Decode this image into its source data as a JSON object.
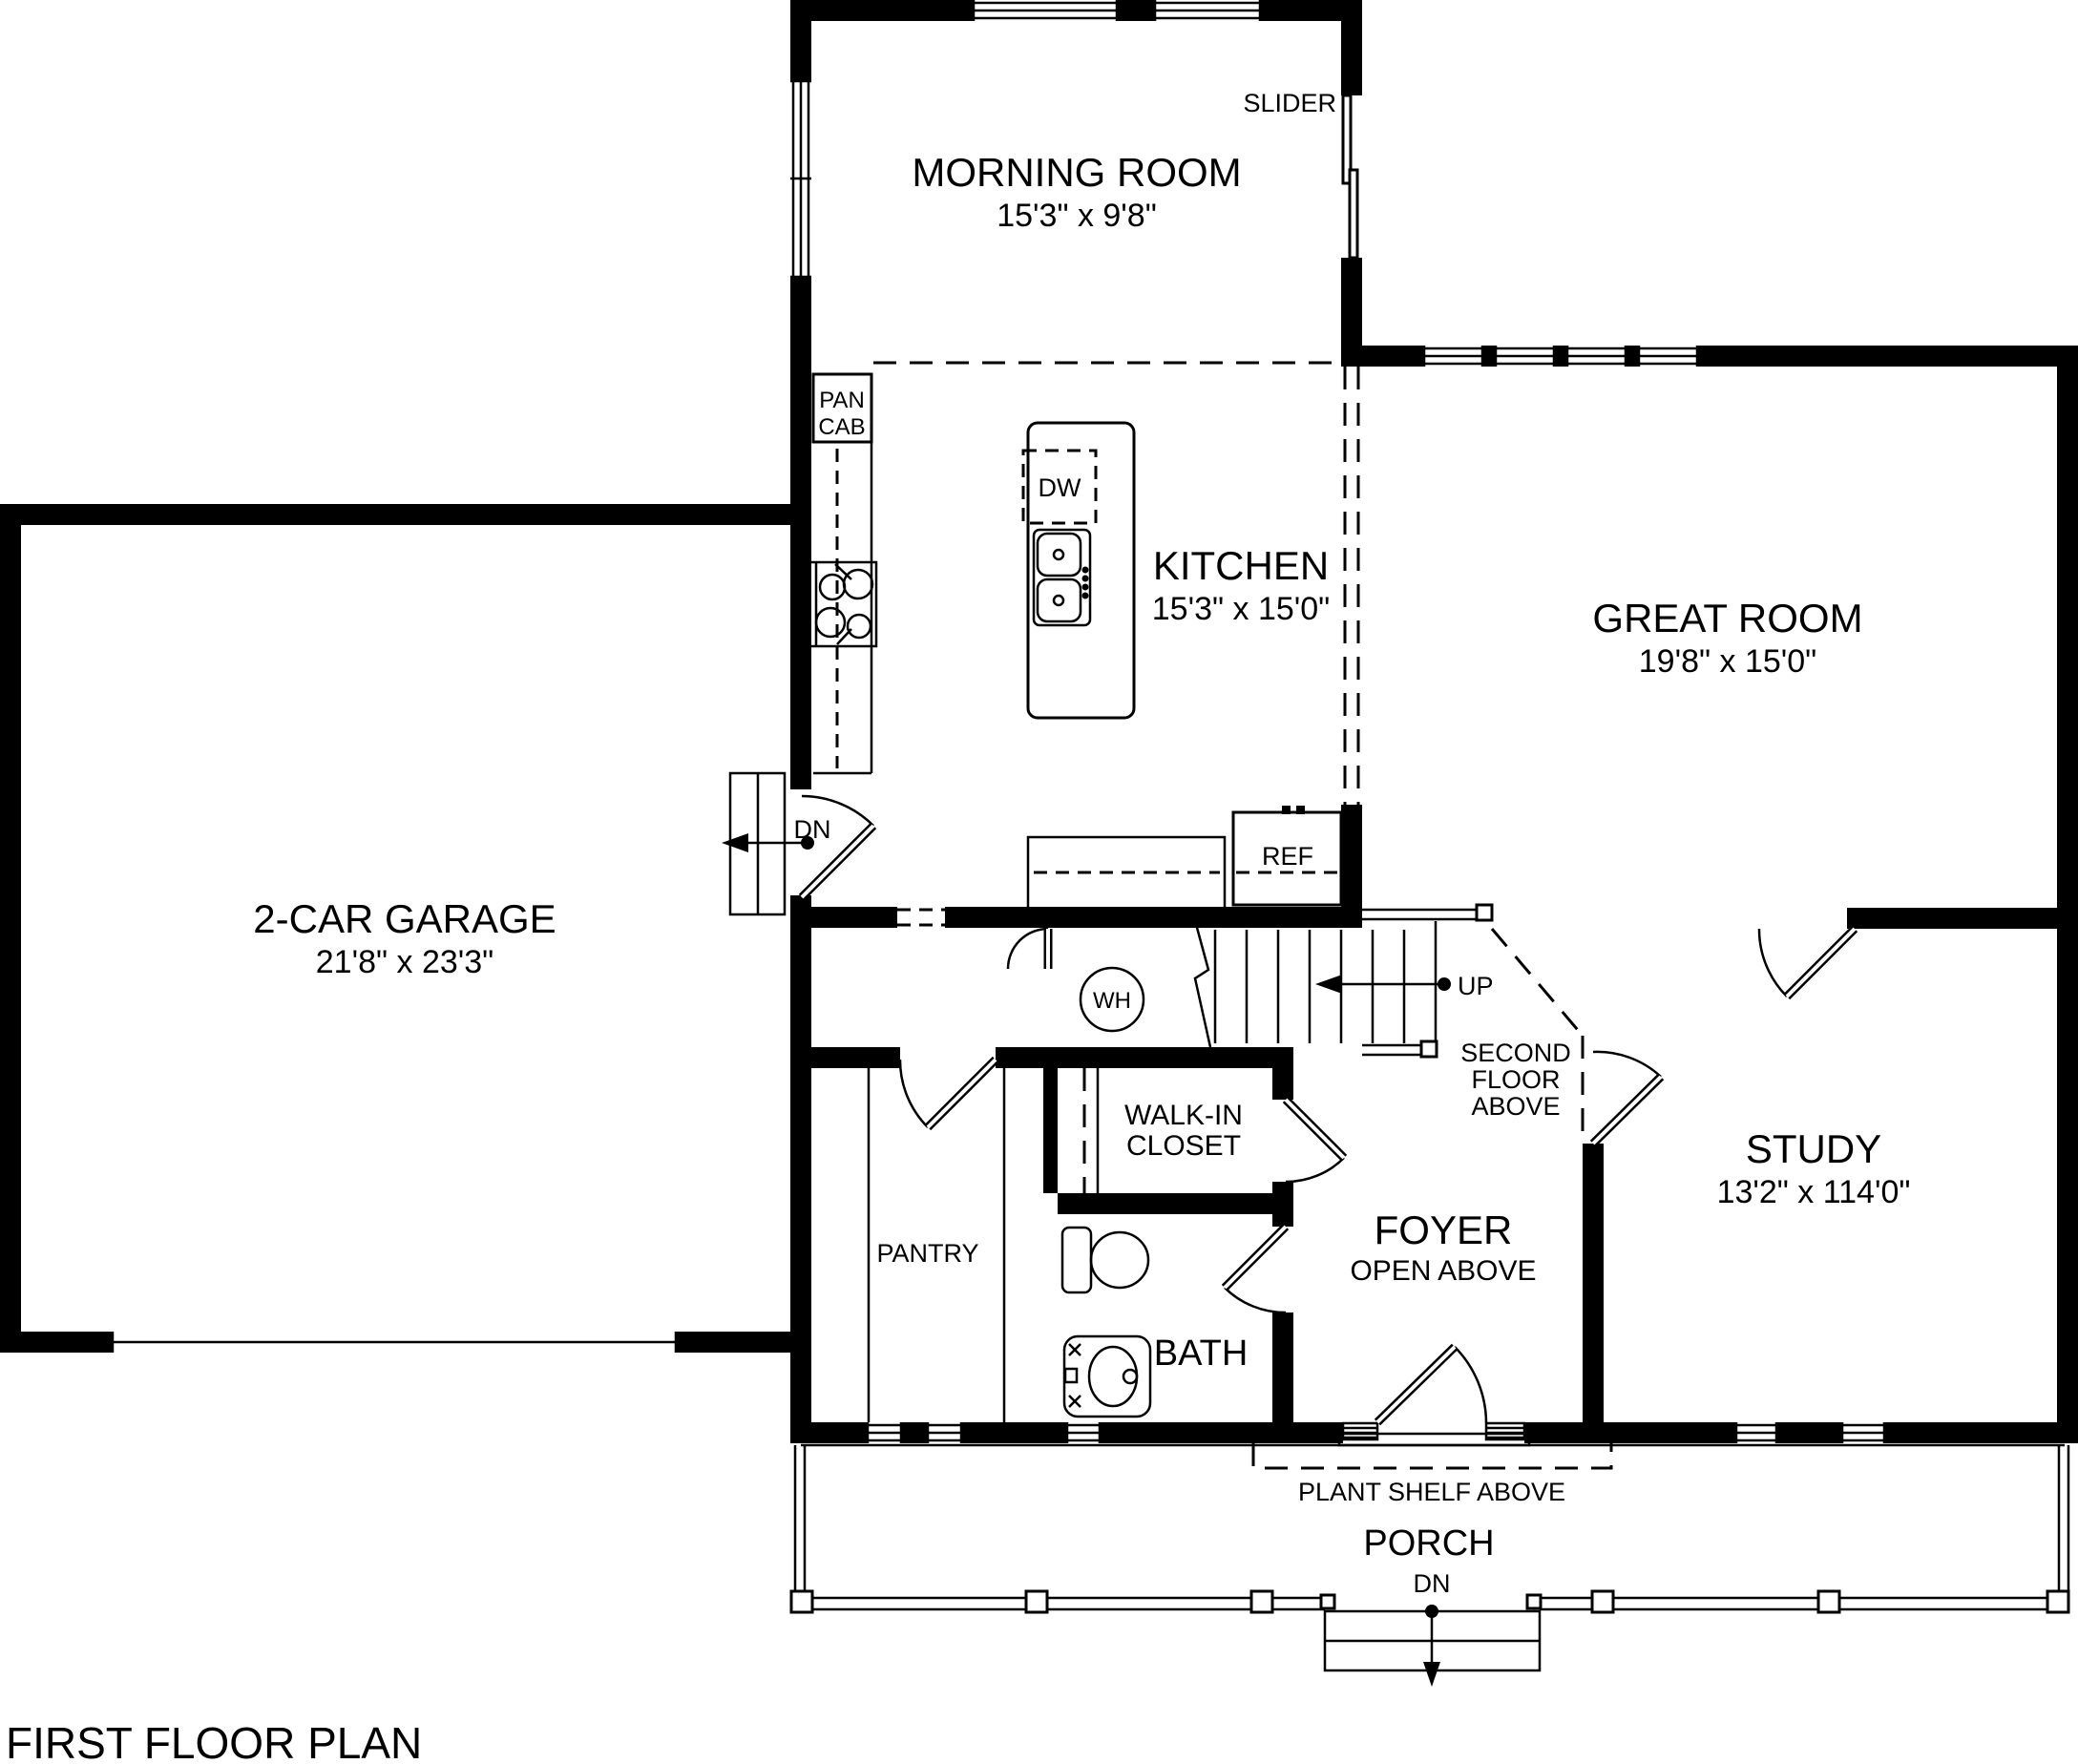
{
  "page": {
    "title": "FIRST FLOOR PLAN",
    "colors": {
      "ink": "#000000",
      "paper": "#ffffff"
    }
  },
  "rooms": {
    "morning_room": {
      "name": "MORNING ROOM",
      "dims": "15'3\" x 9'8\""
    },
    "kitchen": {
      "name": "KITCHEN",
      "dims": "15'3\" x 15'0\""
    },
    "great_room": {
      "name": "GREAT ROOM",
      "dims": "19'8\" x 15'0\""
    },
    "garage": {
      "name": "2-CAR GARAGE",
      "dims": "21'8\" x 23'3\""
    },
    "study": {
      "name": "STUDY",
      "dims": "13'2\" x 114'0\""
    },
    "foyer": {
      "name": "FOYER",
      "note": "OPEN ABOVE"
    },
    "walk_in_closet": {
      "line1": "WALK-IN",
      "line2": "CLOSET"
    },
    "pantry": {
      "name": "PANTRY"
    },
    "bath": {
      "name": "BATH"
    },
    "porch": {
      "name": "PORCH"
    }
  },
  "labels": {
    "slider": "SLIDER",
    "pan": "PAN",
    "cab": "CAB",
    "dishwasher": "DW",
    "refrigerator": "REF",
    "water_heater": "WH",
    "down_garage": "DN",
    "up_stairs": "UP",
    "second_floor_1": "SECOND",
    "second_floor_2": "FLOOR",
    "second_floor_3": "ABOVE",
    "plant_shelf": "PLANT SHELF ABOVE",
    "down_porch": "DN"
  }
}
